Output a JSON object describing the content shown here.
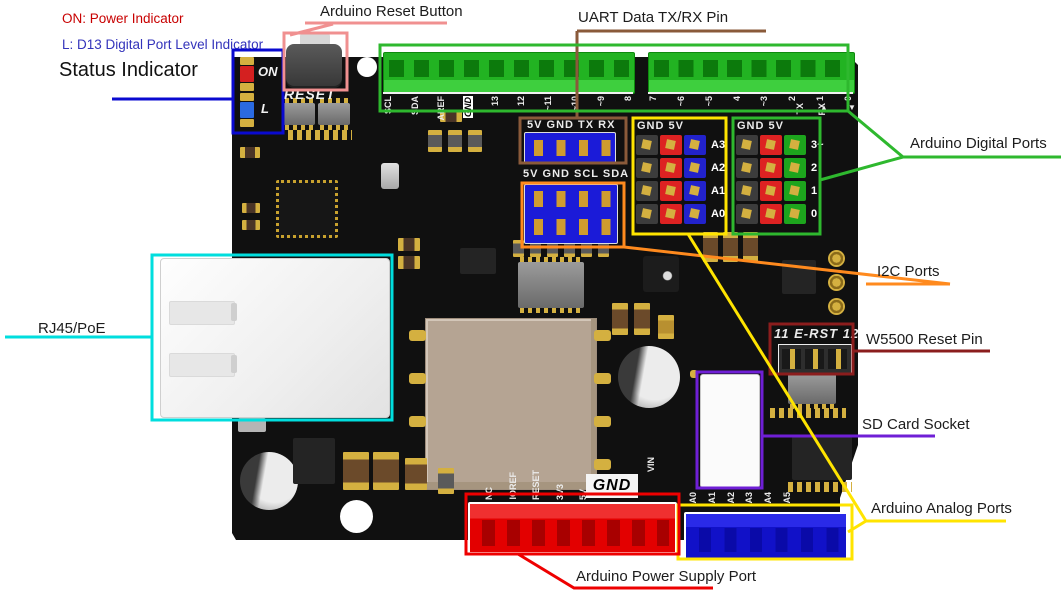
{
  "annotations": {
    "on_power": "ON: Power Indicator",
    "l_d13": "L: D13 Digital Port Level Indicator",
    "status": "Status Indicator",
    "reset_button": "Arduino Reset Button",
    "uart": "UART Data TX/RX Pin",
    "digital_ports": "Arduino Digital Ports",
    "i2c_ports": "I2C Ports",
    "w5500_reset": "W5500 Reset Pin",
    "sd_socket": "SD Card Socket",
    "analog_ports": "Arduino Analog Ports",
    "power_supply": "Arduino Power Supply Port",
    "rj45": "RJ45/PoE"
  },
  "colors": {
    "status_line": "#0a0ad0",
    "reset_callout": "#f09090",
    "uart_callout": "#8a5a3a",
    "digital_callout": "#2eb82e",
    "i2c_callout": "#ff8a1e",
    "w5500_callout": "#8b1d1d",
    "sd_callout": "#6f1fd6",
    "analog_callout": "#ffe400",
    "power_callout": "#ee0000",
    "rj45_callout": "#00dede",
    "label_red": "#c80000",
    "label_blue": "#3333bb"
  },
  "silkscreen": {
    "reset": "RESET",
    "on": "ON",
    "l": "L",
    "digital_row1": [
      "SCL",
      "SDA",
      "AREF",
      "GND",
      "13",
      "12",
      "~11",
      "~10",
      "~9",
      "8"
    ],
    "digital_row2": [
      "7",
      "~6",
      "~5",
      "4",
      "~3",
      "2",
      "1",
      "0"
    ],
    "pin1_arrow": "▲",
    "pin0_arrow": "▼",
    "uart_label": "5V GND TX RX",
    "i2c_label": "5V GND SCL SDA",
    "port_block_header": "GND 5V",
    "tx": "TX",
    "rx": "RX",
    "analog_block_rows": [
      "A3",
      "A2",
      "A1",
      "A0"
    ],
    "digital_block_rows": [
      "3~",
      "2",
      "1",
      "0"
    ],
    "erst": "11 E-RST 12",
    "power_row": [
      "NC",
      "IOREF",
      "RESET",
      "3V3",
      "5V"
    ],
    "gnd": "GND",
    "vin": "VIN",
    "analog_row": [
      "A0",
      "A1",
      "A2",
      "A3",
      "A4",
      "A5"
    ]
  }
}
